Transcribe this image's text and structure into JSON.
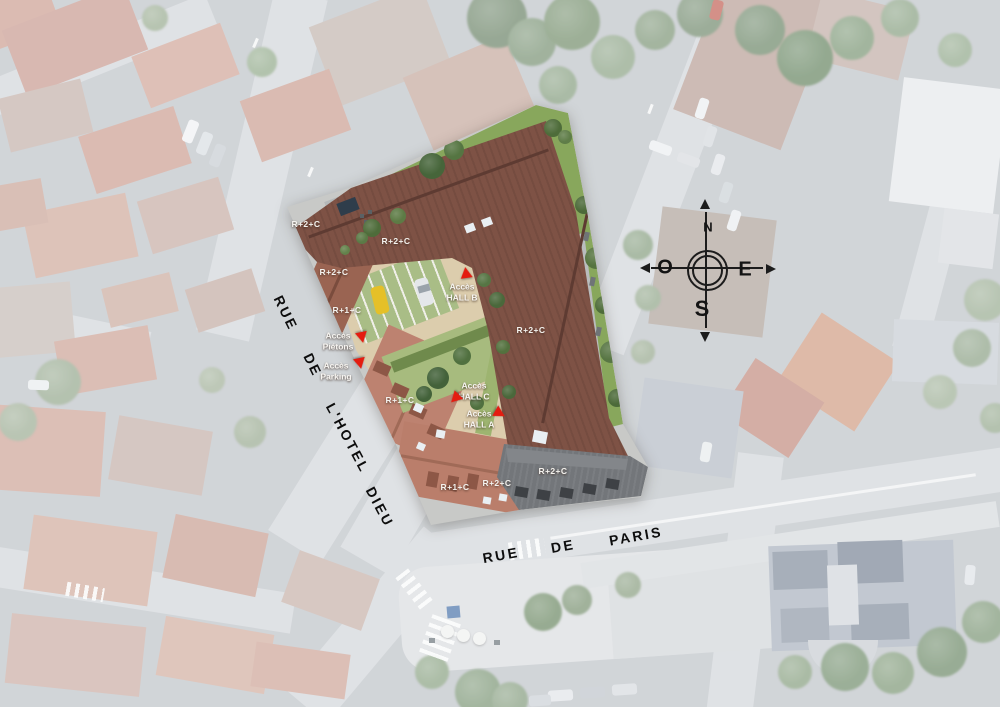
{
  "compass": {
    "north": "N",
    "west": "O",
    "east": "E",
    "south": "S"
  },
  "streets": {
    "rue_hotel_dieu": {
      "name": "RUE DE L'HOTEL DIEU",
      "words": [
        {
          "text": "RUE",
          "x": 286,
          "y": 313,
          "rot": 64
        },
        {
          "text": "DE",
          "x": 313,
          "y": 365,
          "rot": 64
        },
        {
          "text": "L'HOTEL",
          "x": 348,
          "y": 438,
          "rot": 62
        },
        {
          "text": "DIEU",
          "x": 380,
          "y": 507,
          "rot": 62
        }
      ]
    },
    "rue_de_paris": {
      "name": "RUE DE PARIS",
      "words": [
        {
          "text": "RUE",
          "x": 501,
          "y": 555,
          "rot": -10
        },
        {
          "text": "DE",
          "x": 563,
          "y": 546,
          "rot": -10
        },
        {
          "text": "PARIS",
          "x": 636,
          "y": 536,
          "rot": -10
        }
      ]
    }
  },
  "levels": [
    {
      "text": "R+2+C",
      "x": 306,
      "y": 224
    },
    {
      "text": "R+2+C",
      "x": 396,
      "y": 241
    },
    {
      "text": "R+2+C",
      "x": 334,
      "y": 272
    },
    {
      "text": "R+1+C",
      "x": 347,
      "y": 310
    },
    {
      "text": "R+2+C",
      "x": 531,
      "y": 330
    },
    {
      "text": "R+1+C",
      "x": 400,
      "y": 400
    },
    {
      "text": "R+1+C",
      "x": 455,
      "y": 487
    },
    {
      "text": "R+2+C",
      "x": 497,
      "y": 483
    },
    {
      "text": "R+2+C",
      "x": 553,
      "y": 471
    }
  ],
  "access": [
    {
      "line1": "Accès",
      "line2": "HALL B",
      "x": 462,
      "y": 292,
      "ax": 466,
      "ay": 273,
      "arot": -8
    },
    {
      "line1": "Accès",
      "line2": "Piétons",
      "x": 338,
      "y": 341,
      "ax": 362,
      "ay": 338,
      "arot": 168
    },
    {
      "line1": "Accès",
      "line2": "Parking",
      "x": 336,
      "y": 371,
      "ax": 360,
      "ay": 364,
      "arot": 168
    },
    {
      "line1": "Accès",
      "line2": "HALL C",
      "x": 474,
      "y": 391,
      "ax": 455,
      "ay": 399,
      "arot": 225
    },
    {
      "line1": "Accès",
      "line2": "HALL A",
      "x": 479,
      "y": 419,
      "ax": 500,
      "ay": 414,
      "arot": 120
    }
  ],
  "colors": {
    "accent_red": "#e41c10",
    "main_roof_brown": "#7e5245",
    "street_roof_brown": "#9a6452",
    "salmon_roof": "#bd8270",
    "dark_gray_roof": "#73767a",
    "lawn_green": "#88a75c",
    "courtyard_tan": "#dccdad",
    "road_gray": "#d8dade",
    "label_white": "#f4f2ee",
    "street_text_black": "#0d0d0d"
  }
}
